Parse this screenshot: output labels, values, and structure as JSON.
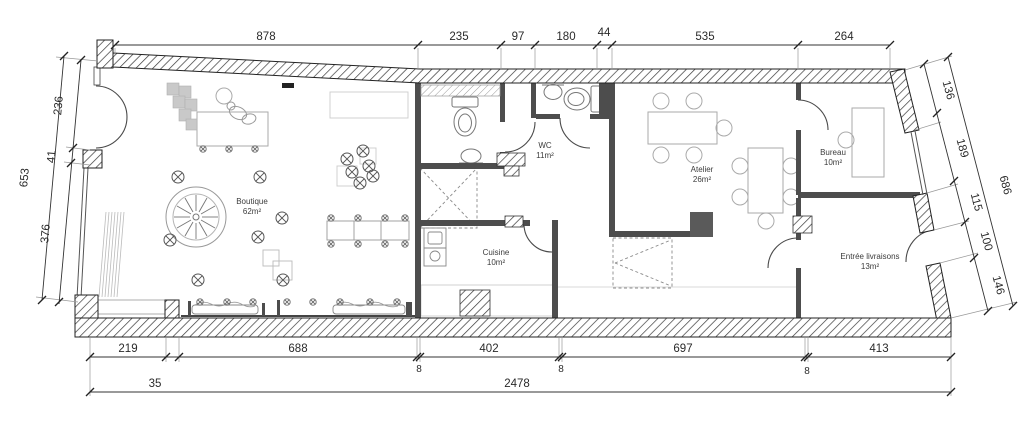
{
  "drawing": {
    "type": "architectural-floor-plan",
    "units": "cm"
  },
  "rooms": [
    {
      "name": "Boutique",
      "area": "62m²"
    },
    {
      "name": "WC",
      "area": "11m²"
    },
    {
      "name": "Cuisine",
      "area": "10m²"
    },
    {
      "name": "Atelier",
      "area": "26m²"
    },
    {
      "name": "Bureau",
      "area": "10m²"
    },
    {
      "name": "Entrée livraisons",
      "area": "13m²"
    }
  ],
  "dims": {
    "top": [
      "878",
      "235",
      "97",
      "180",
      "44",
      "535",
      "264"
    ],
    "bottom": [
      "219",
      "688",
      "402",
      "697",
      "413"
    ],
    "bottom_small": [
      "8",
      "8",
      "8"
    ],
    "bottom_total_row": [
      "35",
      "2478"
    ],
    "left_total": "653",
    "left": [
      "236",
      "41",
      "376"
    ],
    "right_total": "686",
    "right": [
      "136",
      "189",
      "115",
      "100",
      "146"
    ]
  },
  "colors": {
    "wall_interior": "#4d4d4d",
    "hatch_line": "#3a3a3a",
    "furniture_line": "#a8a8a8",
    "dim_text": "#2a2a2a"
  }
}
